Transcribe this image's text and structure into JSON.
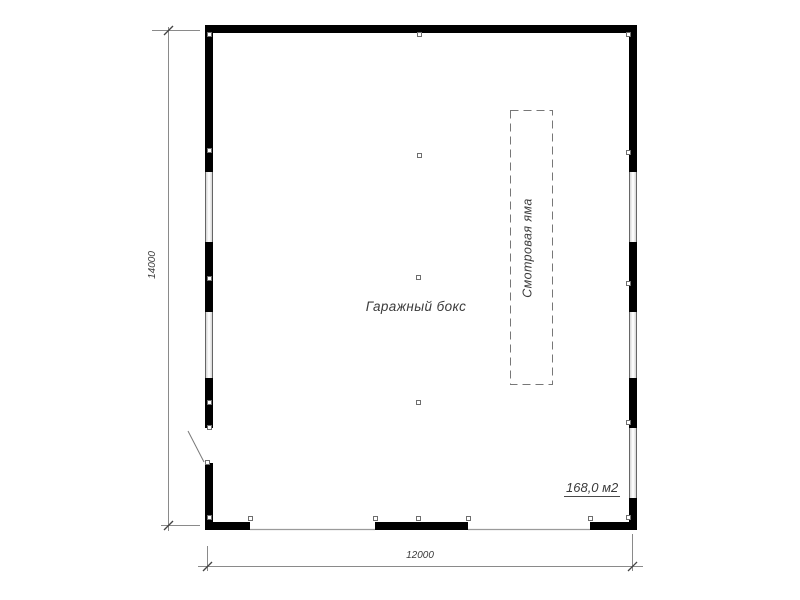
{
  "labels": {
    "room": "Гаражный бокс",
    "pit": "Смотровая яма",
    "area": "168,0 м2"
  },
  "dimensions": {
    "height_mm": "14000",
    "width_mm": "12000"
  },
  "colors": {
    "wall": "#000000",
    "thin_line": "#8a8a8a",
    "dashed_line": "#777777",
    "text": "#3b3b3b"
  },
  "legend": {
    "drawing_type": "garage floor plan",
    "openings": [
      "two gate openings on bottom wall",
      "door opening on left wall",
      "five windows"
    ]
  }
}
